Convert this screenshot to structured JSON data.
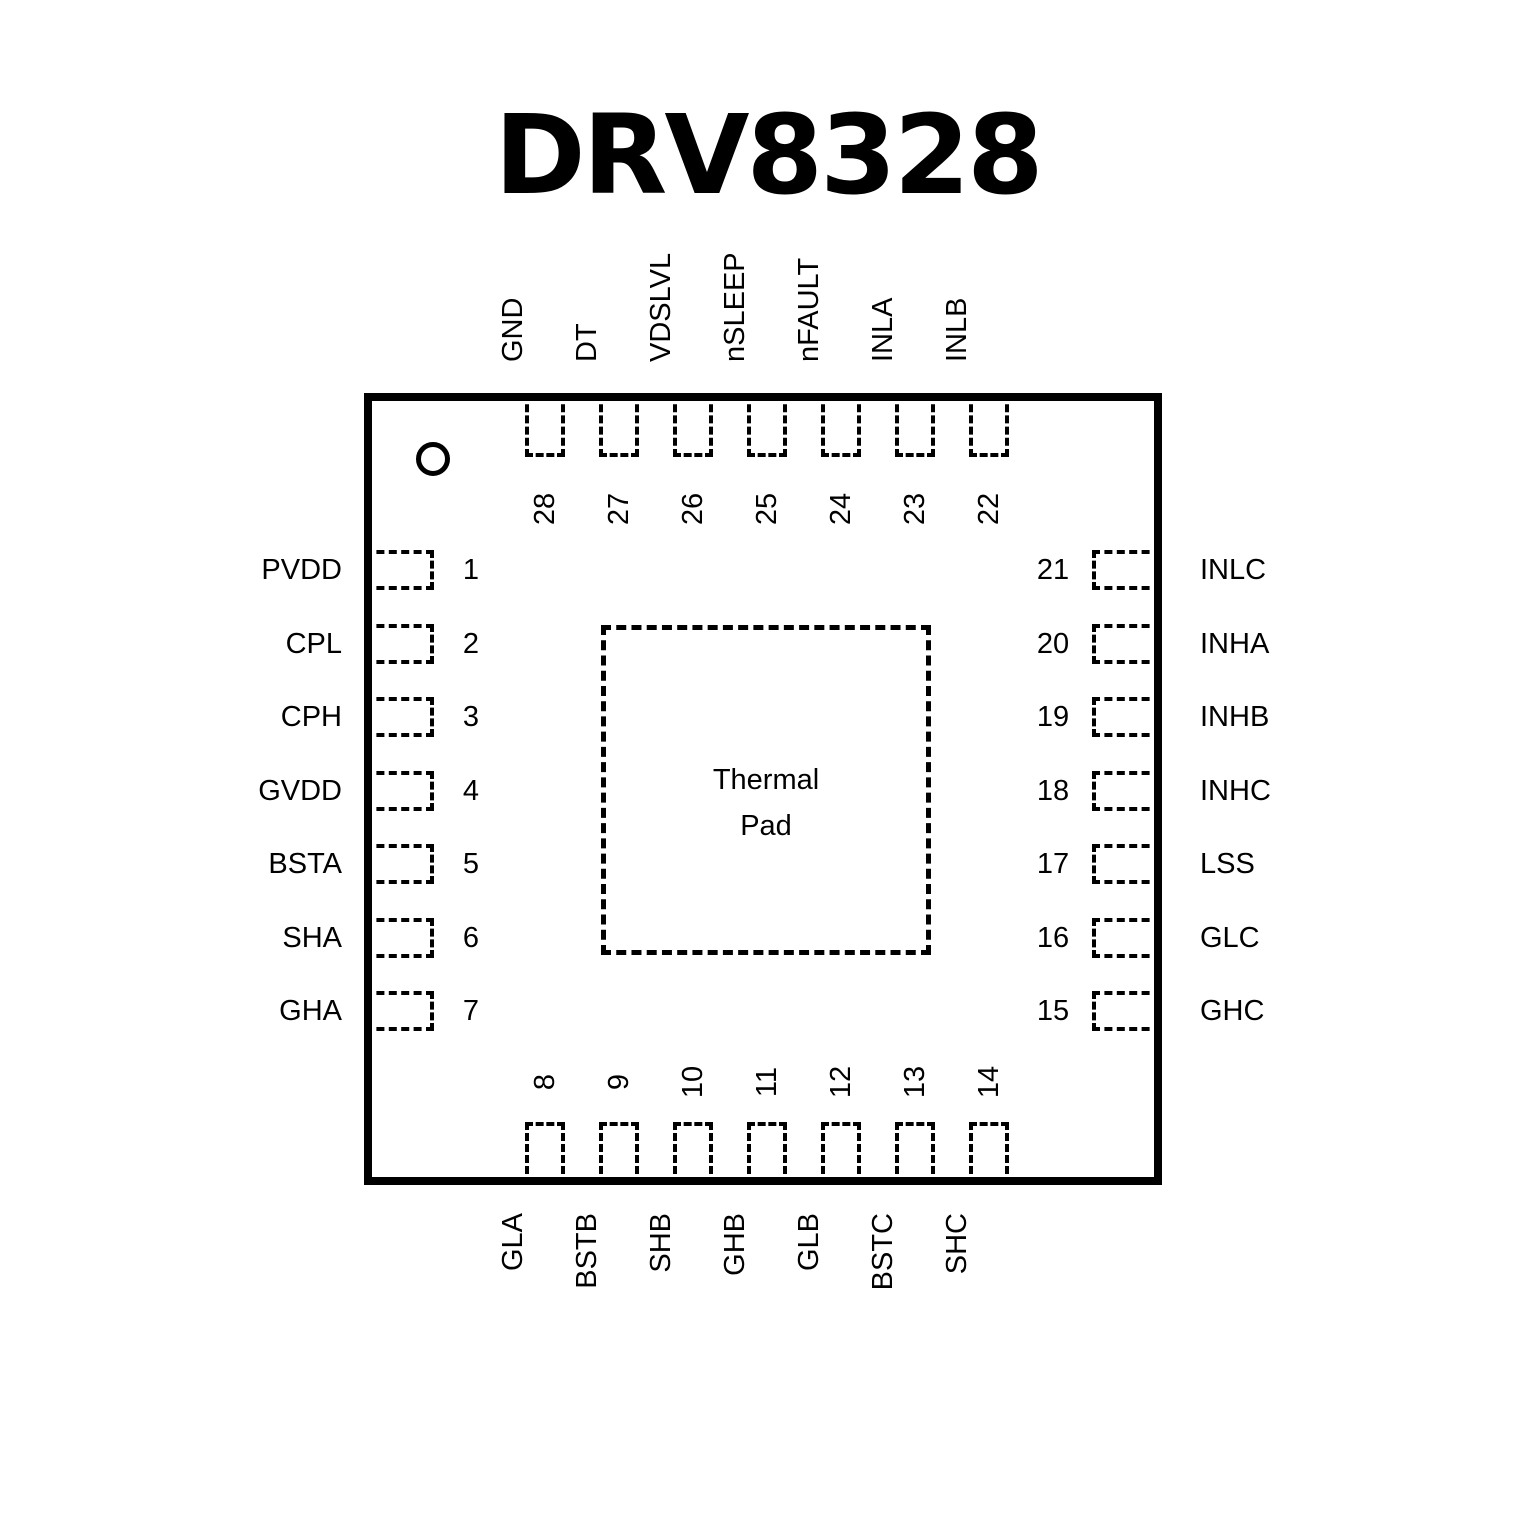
{
  "title": "DRV8328",
  "thermal_pad": {
    "lines": [
      "Thermal",
      "Pad"
    ]
  },
  "colors": {
    "ink": "#000000",
    "background": "#ffffff"
  },
  "pins": {
    "left": [
      {
        "num": "1",
        "label": "PVDD"
      },
      {
        "num": "2",
        "label": "CPL"
      },
      {
        "num": "3",
        "label": "CPH"
      },
      {
        "num": "4",
        "label": "GVDD"
      },
      {
        "num": "5",
        "label": "BSTA"
      },
      {
        "num": "6",
        "label": "SHA"
      },
      {
        "num": "7",
        "label": "GHA"
      }
    ],
    "right": [
      {
        "num": "21",
        "label": "INLC"
      },
      {
        "num": "20",
        "label": "INHA"
      },
      {
        "num": "19",
        "label": "INHB"
      },
      {
        "num": "18",
        "label": "INHC"
      },
      {
        "num": "17",
        "label": "LSS"
      },
      {
        "num": "16",
        "label": "GLC"
      },
      {
        "num": "15",
        "label": "GHC"
      }
    ],
    "top": [
      {
        "num": "28",
        "label": "GND"
      },
      {
        "num": "27",
        "label": "DT"
      },
      {
        "num": "26",
        "label": "VDSLVL"
      },
      {
        "num": "25",
        "label": "nSLEEP"
      },
      {
        "num": "24",
        "label": "nFAULT"
      },
      {
        "num": "23",
        "label": "INLA"
      },
      {
        "num": "22",
        "label": "INLB"
      }
    ],
    "bottom": [
      {
        "num": "8",
        "label": "GLA"
      },
      {
        "num": "9",
        "label": "BSTB"
      },
      {
        "num": "10",
        "label": "SHB"
      },
      {
        "num": "11",
        "label": "GHB"
      },
      {
        "num": "12",
        "label": "GLB"
      },
      {
        "num": "13",
        "label": "BSTC"
      },
      {
        "num": "14",
        "label": "SHC"
      }
    ]
  }
}
